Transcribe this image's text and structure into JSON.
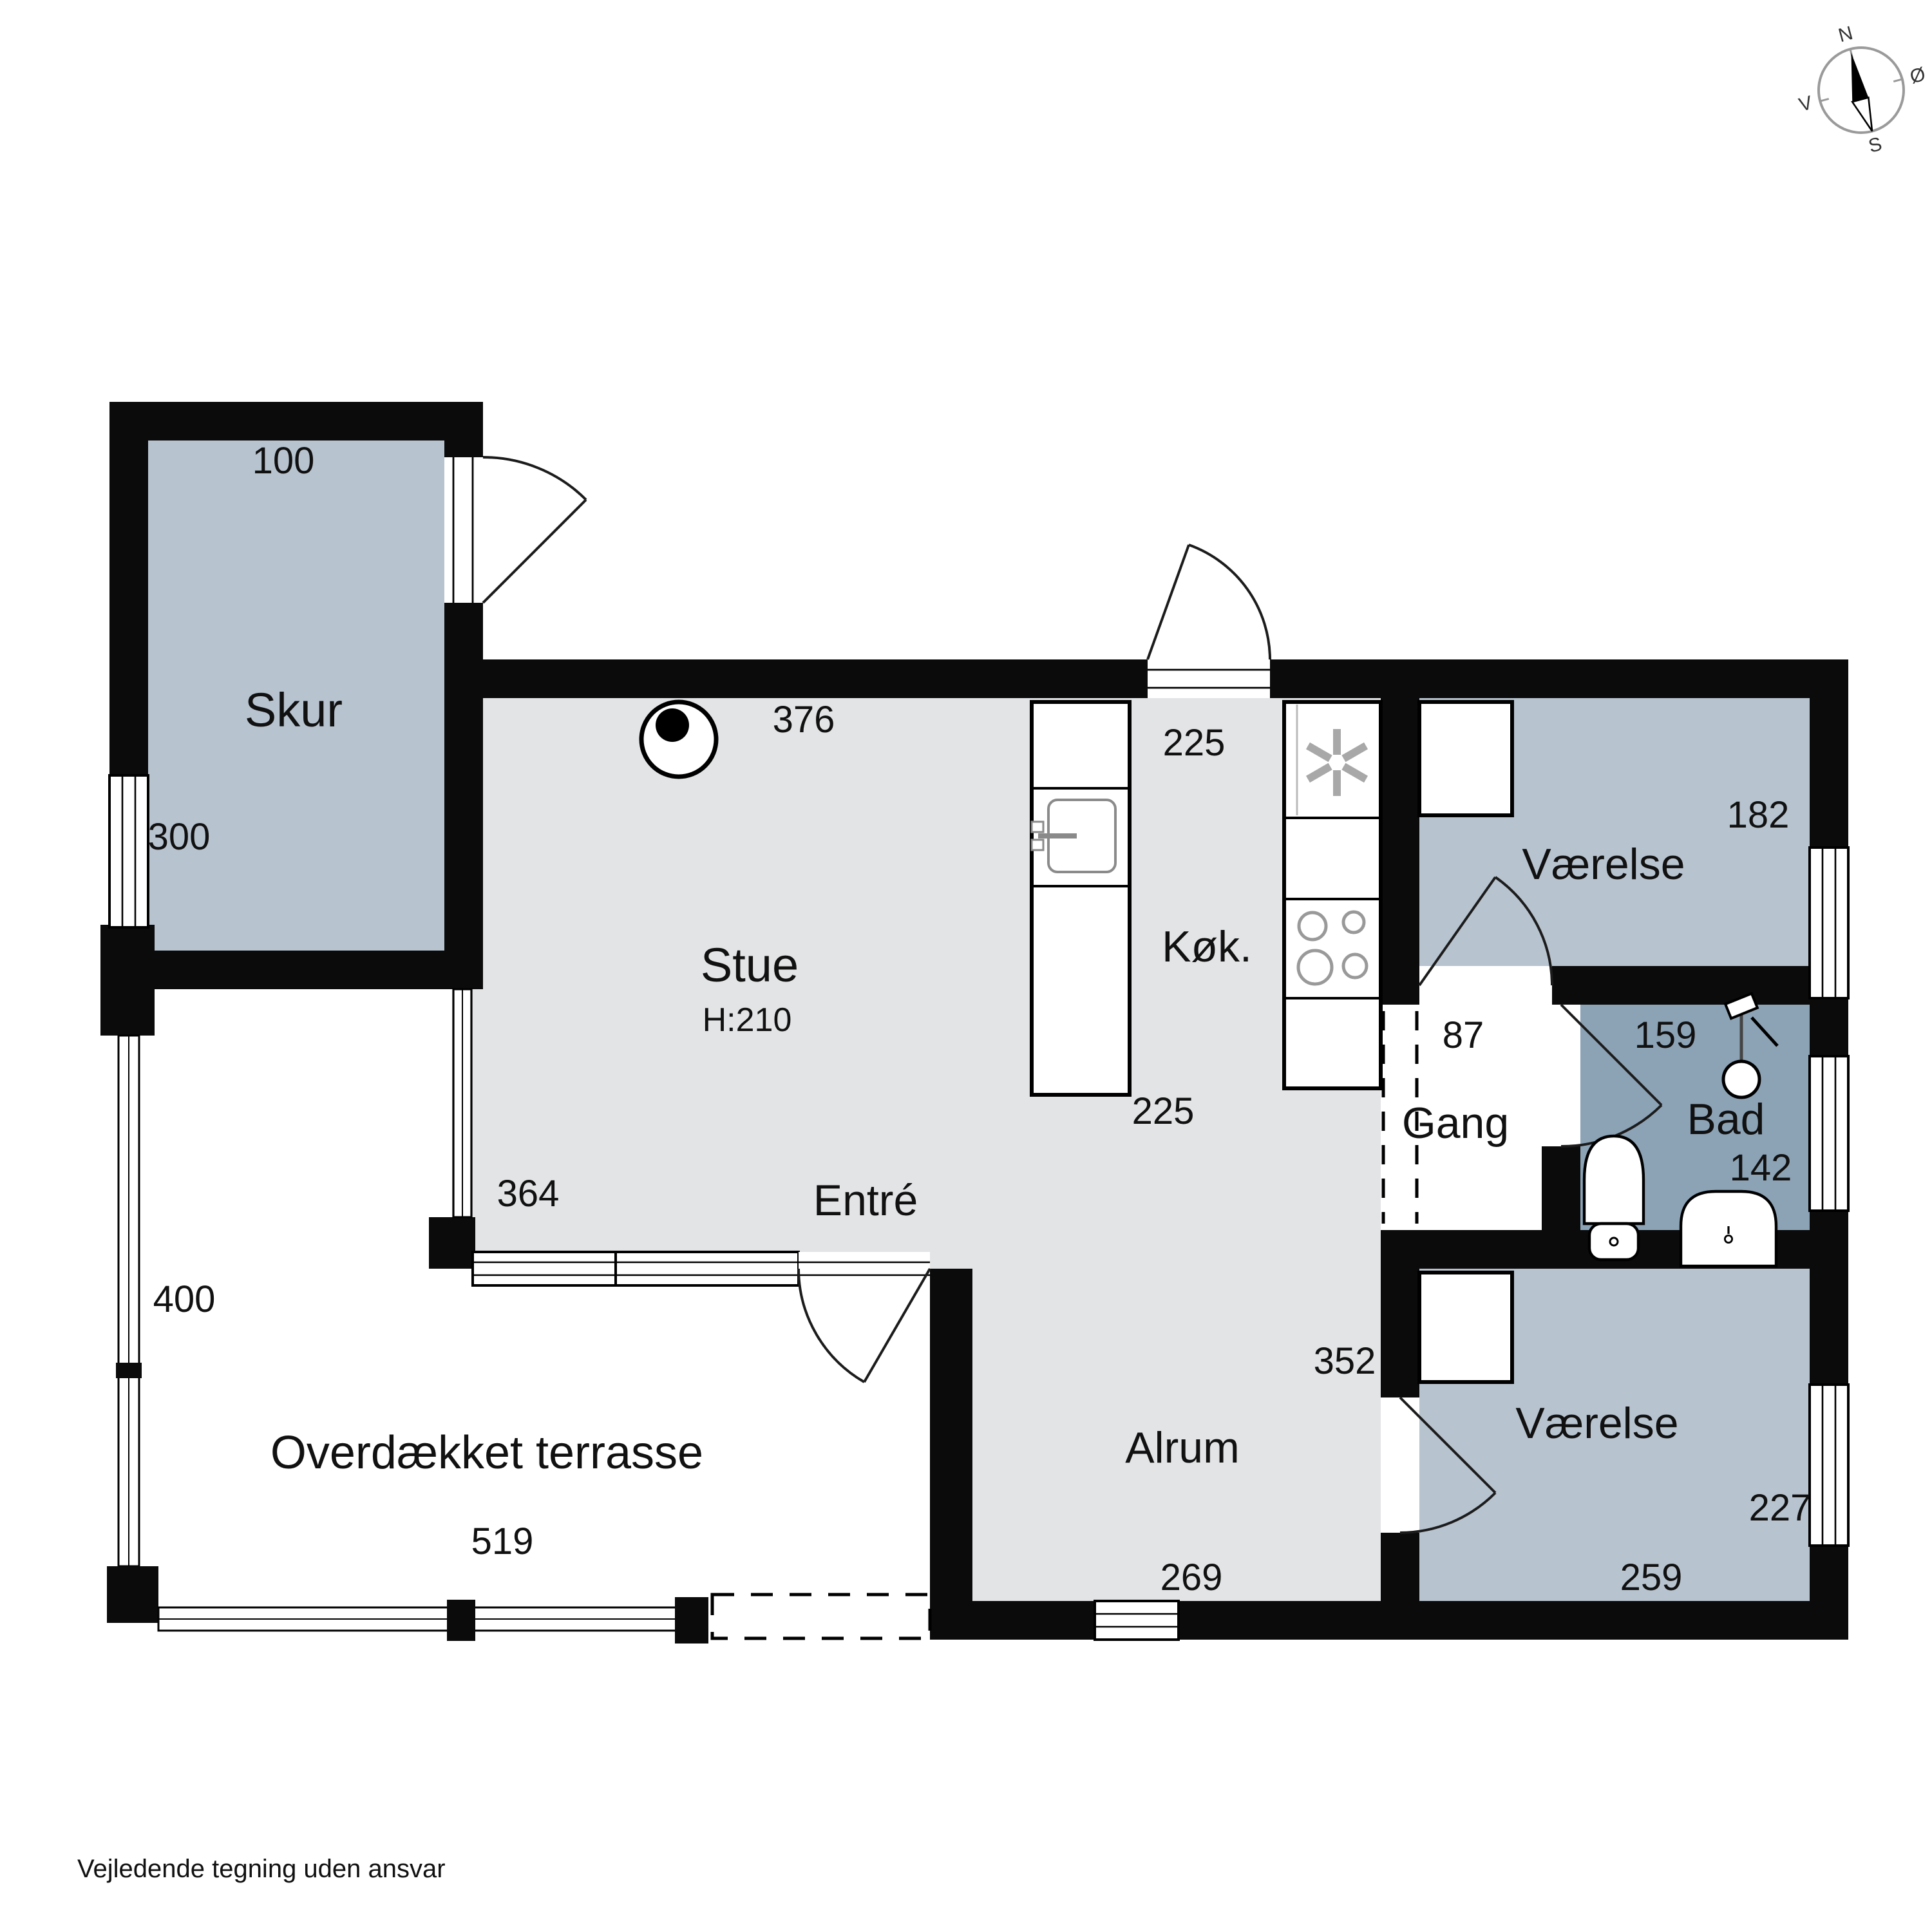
{
  "compass": {
    "north": "N",
    "east": "Ø",
    "south": "S",
    "west": "V"
  },
  "rooms": {
    "skur": {
      "label": "Skur",
      "dim_top": "100",
      "dim_left": "300"
    },
    "stue": {
      "label": "Stue",
      "ceiling_height": "H:210",
      "dim_top": "376",
      "dim_left": "364"
    },
    "entre": {
      "label": "Entré"
    },
    "kok": {
      "label": "Køk.",
      "dim_top": "225",
      "dim_bottom": "225"
    },
    "vaerelse_ne": {
      "label": "Værelse",
      "dim_right": "182"
    },
    "gang": {
      "label": "Gang",
      "dim_top": "87"
    },
    "bad": {
      "label": "Bad",
      "dim_top": "159",
      "dim_right": "142"
    },
    "vaerelse_se": {
      "label": "Værelse",
      "dim_door": "352",
      "dim_right": "227",
      "dim_bottom": "259"
    },
    "alrum": {
      "label": "Alrum",
      "dim_bottom": "269"
    },
    "terrasse": {
      "label": "Overdækket terrasse",
      "dim_left": "400",
      "dim_bottom": "519"
    }
  },
  "footer": {
    "disclaimer": "Vejledende tegning uden ansvar"
  },
  "palette": {
    "wall": "#0b0b0b",
    "room_light": "#e3e4e6",
    "room_blue": "#b7c3cf",
    "room_bad": "#8ca3b6"
  }
}
